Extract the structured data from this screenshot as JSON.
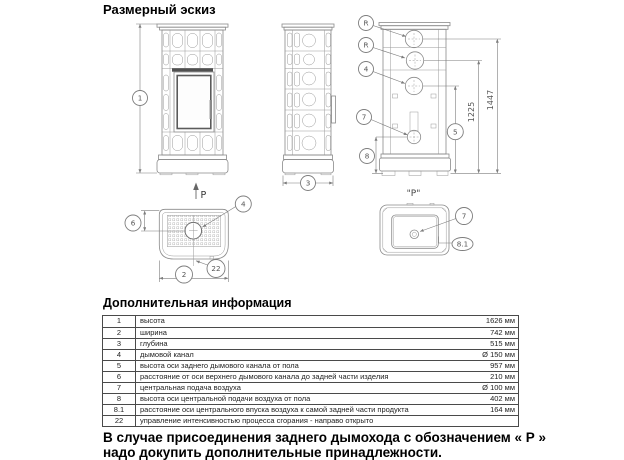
{
  "page": {
    "title": "Размерный эскиз",
    "table_title": "Дополнительная информация",
    "footnote_line1": "В случае присоединения заднего дымохода с обозначением « Р »",
    "footnote_line2": "надо докупить дополнительные принадлежности."
  },
  "drawing": {
    "balloons": {
      "height": "1",
      "width": "2",
      "depth": "3",
      "flue_top": "4",
      "flue_rear": "4",
      "flue_height": "5",
      "flue_offset": "6",
      "air_rear": "7",
      "air_bottom": "7",
      "air_height": "8",
      "air_offset": "8.1",
      "control": "22",
      "r_upper": "R",
      "r_lower": "R"
    },
    "dimensions": {
      "lower_outlet": "1225",
      "upper_outlet": "1447"
    },
    "p_arrow": "P",
    "p_caption": "\"P\""
  },
  "table": {
    "rows": [
      {
        "no": "1",
        "desc": "высота",
        "val": "1626 мм"
      },
      {
        "no": "2",
        "desc": "ширина",
        "val": "742 мм"
      },
      {
        "no": "3",
        "desc": "глубина",
        "val": "515 мм"
      },
      {
        "no": "4",
        "desc": "дымовой канал",
        "val": "Ø 150 мм"
      },
      {
        "no": "5",
        "desc": "высота оси заднего дымового канала от пола",
        "val": "957 мм"
      },
      {
        "no": "6",
        "desc": "расстояние от оси верхнего дымового канала до задней части изделия",
        "val": "210 мм"
      },
      {
        "no": "7",
        "desc": "центральная подача воздуха",
        "val": "Ø 100 мм"
      },
      {
        "no": "8",
        "desc": "высота оси центральной подачи воздуха от пола",
        "val": "402 мм"
      },
      {
        "no": "8.1",
        "desc": "расстояние оси центрального впуска воздуха к самой задней части продукта",
        "val": "164 мм"
      },
      {
        "no": "22",
        "desc": "управление интенсивностью процесса сгорания - направо открыто",
        "val": ""
      }
    ]
  }
}
